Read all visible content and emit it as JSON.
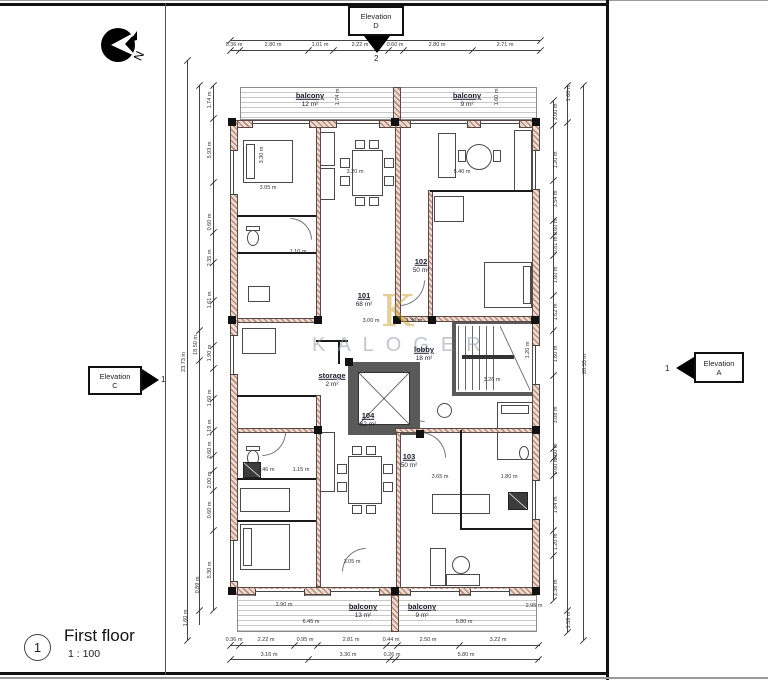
{
  "sheet": {
    "number": "1",
    "title": "First floor",
    "scale": "1 : 100"
  },
  "north_label": "N",
  "elevation_markers": {
    "d": {
      "line1": "Elevation",
      "line2": "D",
      "grid_ref": "2"
    },
    "c": {
      "line1": "Elevation",
      "line2": "C",
      "grid_ref": "1"
    },
    "a": {
      "line1": "Elevation",
      "line2": "A",
      "grid_ref": "1"
    }
  },
  "watermark": {
    "monogram": "K",
    "name": "KALOGER"
  },
  "rooms": [
    {
      "name": "balcony",
      "area": "12 m²",
      "x": 310,
      "y": 100
    },
    {
      "name": "balcony",
      "area": "9 m²",
      "x": 467,
      "y": 100
    },
    {
      "name": "101",
      "area": "68 m²",
      "x": 364,
      "y": 300
    },
    {
      "name": "102",
      "area": "50 m²",
      "x": 421,
      "y": 266
    },
    {
      "name": "103",
      "area": "50 m²",
      "x": 409,
      "y": 461
    },
    {
      "name": "104",
      "area": "62 m²",
      "x": 368,
      "y": 420
    },
    {
      "name": "lobby",
      "area": "18 m²",
      "x": 424,
      "y": 354
    },
    {
      "name": "storage",
      "area": "2 m²",
      "x": 332,
      "y": 380
    },
    {
      "name": "balcony",
      "area": "13 m²",
      "x": 363,
      "y": 611
    },
    {
      "name": "balcony",
      "area": "9 m²",
      "x": 422,
      "y": 611
    }
  ],
  "dimensions": [
    {
      "t": "12.60 m",
      "x": 385,
      "y": 35,
      "r": 0
    },
    {
      "t": "0.36 m",
      "x": 234,
      "y": 45,
      "r": 0
    },
    {
      "t": "2.80 m",
      "x": 273,
      "y": 45,
      "r": 0
    },
    {
      "t": "1.01 m",
      "x": 320,
      "y": 45,
      "r": 0
    },
    {
      "t": "2.22 m",
      "x": 360,
      "y": 45,
      "r": 0
    },
    {
      "t": "0.60 m",
      "x": 395,
      "y": 45,
      "r": 0
    },
    {
      "t": "2.80 m",
      "x": 437,
      "y": 45,
      "r": 0
    },
    {
      "t": "2.71 m",
      "x": 505,
      "y": 45,
      "r": 0
    },
    {
      "t": "0.36 m",
      "x": 234,
      "y": 640,
      "r": 0
    },
    {
      "t": "2.22 m",
      "x": 266,
      "y": 640,
      "r": 0
    },
    {
      "t": "0.95 m",
      "x": 305,
      "y": 640,
      "r": 0
    },
    {
      "t": "2.81 m",
      "x": 351,
      "y": 640,
      "r": 0
    },
    {
      "t": "0.44 m",
      "x": 391,
      "y": 640,
      "r": 0
    },
    {
      "t": "2.50 m",
      "x": 428,
      "y": 640,
      "r": 0
    },
    {
      "t": "3.22 m",
      "x": 498,
      "y": 640,
      "r": 0
    },
    {
      "t": "3.16 m",
      "x": 269,
      "y": 655,
      "r": 0
    },
    {
      "t": "3.30 m",
      "x": 348,
      "y": 655,
      "r": 0
    },
    {
      "t": "0.26 m",
      "x": 392,
      "y": 655,
      "r": 0
    },
    {
      "t": "5.80 m",
      "x": 466,
      "y": 655,
      "r": 0
    },
    {
      "t": "1.74 m",
      "x": 210,
      "y": 100,
      "r": 1
    },
    {
      "t": "5.93 m",
      "x": 210,
      "y": 150,
      "r": 1
    },
    {
      "t": "0.60 m",
      "x": 210,
      "y": 222,
      "r": 1
    },
    {
      "t": "2.35 m",
      "x": 210,
      "y": 258,
      "r": 1
    },
    {
      "t": "1.61 m",
      "x": 210,
      "y": 300,
      "r": 1
    },
    {
      "t": "1.90 m",
      "x": 210,
      "y": 353,
      "r": 1
    },
    {
      "t": "1.60 m",
      "x": 210,
      "y": 398,
      "r": 1
    },
    {
      "t": "1.19 m",
      "x": 210,
      "y": 428,
      "r": 1
    },
    {
      "t": "0.60 m",
      "x": 210,
      "y": 450,
      "r": 1
    },
    {
      "t": "2.00 m",
      "x": 210,
      "y": 480,
      "r": 1
    },
    {
      "t": "0.60 m",
      "x": 210,
      "y": 510,
      "r": 1
    },
    {
      "t": "5.30 m",
      "x": 210,
      "y": 570,
      "r": 1
    },
    {
      "t": "0.89 m",
      "x": 198,
      "y": 585,
      "r": 1
    },
    {
      "t": "1.60 m",
      "x": 186,
      "y": 618,
      "r": 1
    },
    {
      "t": "18.50 m",
      "x": 196,
      "y": 345,
      "r": 1
    },
    {
      "t": "23.73 m",
      "x": 184,
      "y": 362,
      "r": 1
    },
    {
      "t": "1.68 m",
      "x": 569,
      "y": 93,
      "r": 1
    },
    {
      "t": "3.00 m",
      "x": 556,
      "y": 112,
      "r": 1
    },
    {
      "t": "1.20 m",
      "x": 556,
      "y": 160,
      "r": 1
    },
    {
      "t": "3.54 m",
      "x": 556,
      "y": 199,
      "r": 1
    },
    {
      "t": "0.60 m",
      "x": 556,
      "y": 227,
      "r": 1
    },
    {
      "t": "0.81 m",
      "x": 556,
      "y": 245,
      "r": 1
    },
    {
      "t": "1.60 m",
      "x": 556,
      "y": 275,
      "r": 1
    },
    {
      "t": "1.62 m",
      "x": 556,
      "y": 312,
      "r": 1
    },
    {
      "t": "1.60 m",
      "x": 556,
      "y": 354,
      "r": 1
    },
    {
      "t": "3.08 m",
      "x": 556,
      "y": 415,
      "r": 1
    },
    {
      "t": "0.60 m",
      "x": 556,
      "y": 452,
      "r": 1
    },
    {
      "t": "0.60 m",
      "x": 556,
      "y": 466,
      "r": 1
    },
    {
      "t": "1.84 m",
      "x": 556,
      "y": 505,
      "r": 1
    },
    {
      "t": "1.20 m",
      "x": 556,
      "y": 542,
      "r": 1
    },
    {
      "t": "3.38 m",
      "x": 556,
      "y": 588,
      "r": 1
    },
    {
      "t": "1.59 m",
      "x": 569,
      "y": 620,
      "r": 1
    },
    {
      "t": "20.55 m",
      "x": 585,
      "y": 364,
      "r": 1
    },
    {
      "t": "3.05 m",
      "x": 268,
      "y": 188,
      "r": 0
    },
    {
      "t": "3.30 m",
      "x": 262,
      "y": 155,
      "r": 1
    },
    {
      "t": "3.20 m",
      "x": 355,
      "y": 172,
      "r": 0
    },
    {
      "t": "5.40 m",
      "x": 462,
      "y": 172,
      "r": 0
    },
    {
      "t": "1.60 m",
      "x": 497,
      "y": 97,
      "r": 1
    },
    {
      "t": "1.74 m",
      "x": 338,
      "y": 97,
      "r": 1
    },
    {
      "t": "3.00 m",
      "x": 371,
      "y": 321,
      "r": 0
    },
    {
      "t": "1.30 m",
      "x": 414,
      "y": 321,
      "r": 0
    },
    {
      "t": "3.26 m",
      "x": 492,
      "y": 380,
      "r": 0
    },
    {
      "t": "1.20 m",
      "x": 528,
      "y": 350,
      "r": 1
    },
    {
      "t": "3.65 m",
      "x": 440,
      "y": 477,
      "r": 0
    },
    {
      "t": "1.80 m",
      "x": 509,
      "y": 477,
      "r": 0
    },
    {
      "t": "1.10 m",
      "x": 298,
      "y": 252,
      "r": 0
    },
    {
      "t": "1.15 m",
      "x": 301,
      "y": 470,
      "r": 0
    },
    {
      "t": "1.46 m",
      "x": 266,
      "y": 470,
      "r": 0
    },
    {
      "t": "2.90 m",
      "x": 284,
      "y": 605,
      "r": 0
    },
    {
      "t": "6.45 m",
      "x": 311,
      "y": 622,
      "r": 0
    },
    {
      "t": "5.80 m",
      "x": 464,
      "y": 622,
      "r": 0
    },
    {
      "t": "2.95 m",
      "x": 534,
      "y": 606,
      "r": 0
    },
    {
      "t": "3.05 m",
      "x": 352,
      "y": 562,
      "r": 0
    }
  ]
}
